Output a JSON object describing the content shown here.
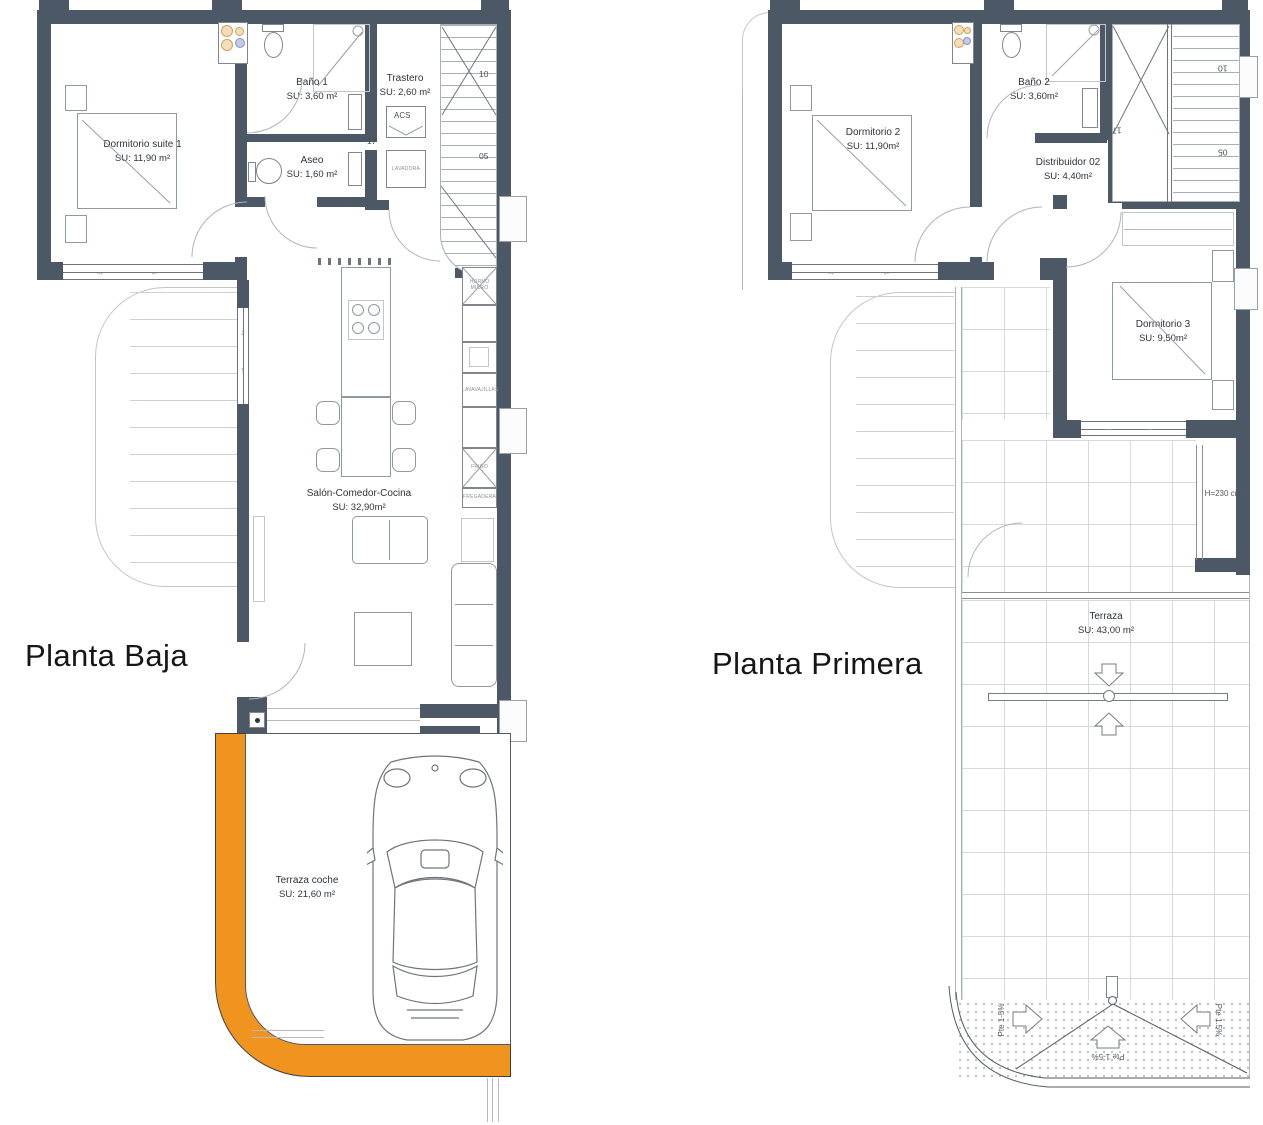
{
  "colors": {
    "wall": "#4d5866",
    "orange": "#f0941f",
    "grid_line": "#d6d9dd"
  },
  "icons": {
    "arrow_right": "→",
    "arrow_left": "←",
    "arrow_up": "↑",
    "arrow_down": "↓"
  },
  "baja": {
    "title": "Planta Baja",
    "rooms": {
      "dormitorio_suite": {
        "name": "Dormitorio suite 1",
        "area": "SU: 11,90 m²"
      },
      "bano1": {
        "name": "Baño 1",
        "area": "SU: 3,60 m²"
      },
      "trastero": {
        "name": "Trastero",
        "area": "SU: 2,60 m²"
      },
      "aseo": {
        "name": "Aseo",
        "area": "SU: 1,60 m²"
      },
      "salon": {
        "name": "Salón-Comedor-Cocina",
        "area": "SU: 32,90m²"
      },
      "terraza_coche": {
        "name": "Terraza coche",
        "area": "SU: 21,60 m²"
      }
    },
    "appliances": {
      "acs": "ACS",
      "lavadora": "LAVADORA",
      "horno_micro": "HORNO MICRO",
      "lavavajillas": "LAVAVAJILLAS",
      "frigo": "FRIGO",
      "fregadera": "FREGADERA"
    },
    "stair_numbers": {
      "n10": "10",
      "n05": "05",
      "n17": "17"
    }
  },
  "primera": {
    "title": "Planta Primera",
    "rooms": {
      "dormitorio2": {
        "name": "Dormitorio 2",
        "area": "SU: 11,90m²"
      },
      "bano2": {
        "name": "Baño 2",
        "area": "SU: 3,60m²"
      },
      "distribuidor": {
        "name": "Distribuidor 02",
        "area": "SU: 4,40m²"
      },
      "dormitorio3": {
        "name": "Dormitorio 3",
        "area": "SU: 9,50m²"
      },
      "terraza": {
        "name": "Terraza",
        "area": "SU: 43,00 m²"
      }
    },
    "notes": {
      "height": "H=230 cm",
      "pte_left": "Pte 1-5%",
      "pte_mid": "Pte 1-5%",
      "pte_right": "Pte 1.5%"
    },
    "stair_numbers": {
      "n10": "10",
      "n05": "05",
      "n17": "17"
    }
  }
}
